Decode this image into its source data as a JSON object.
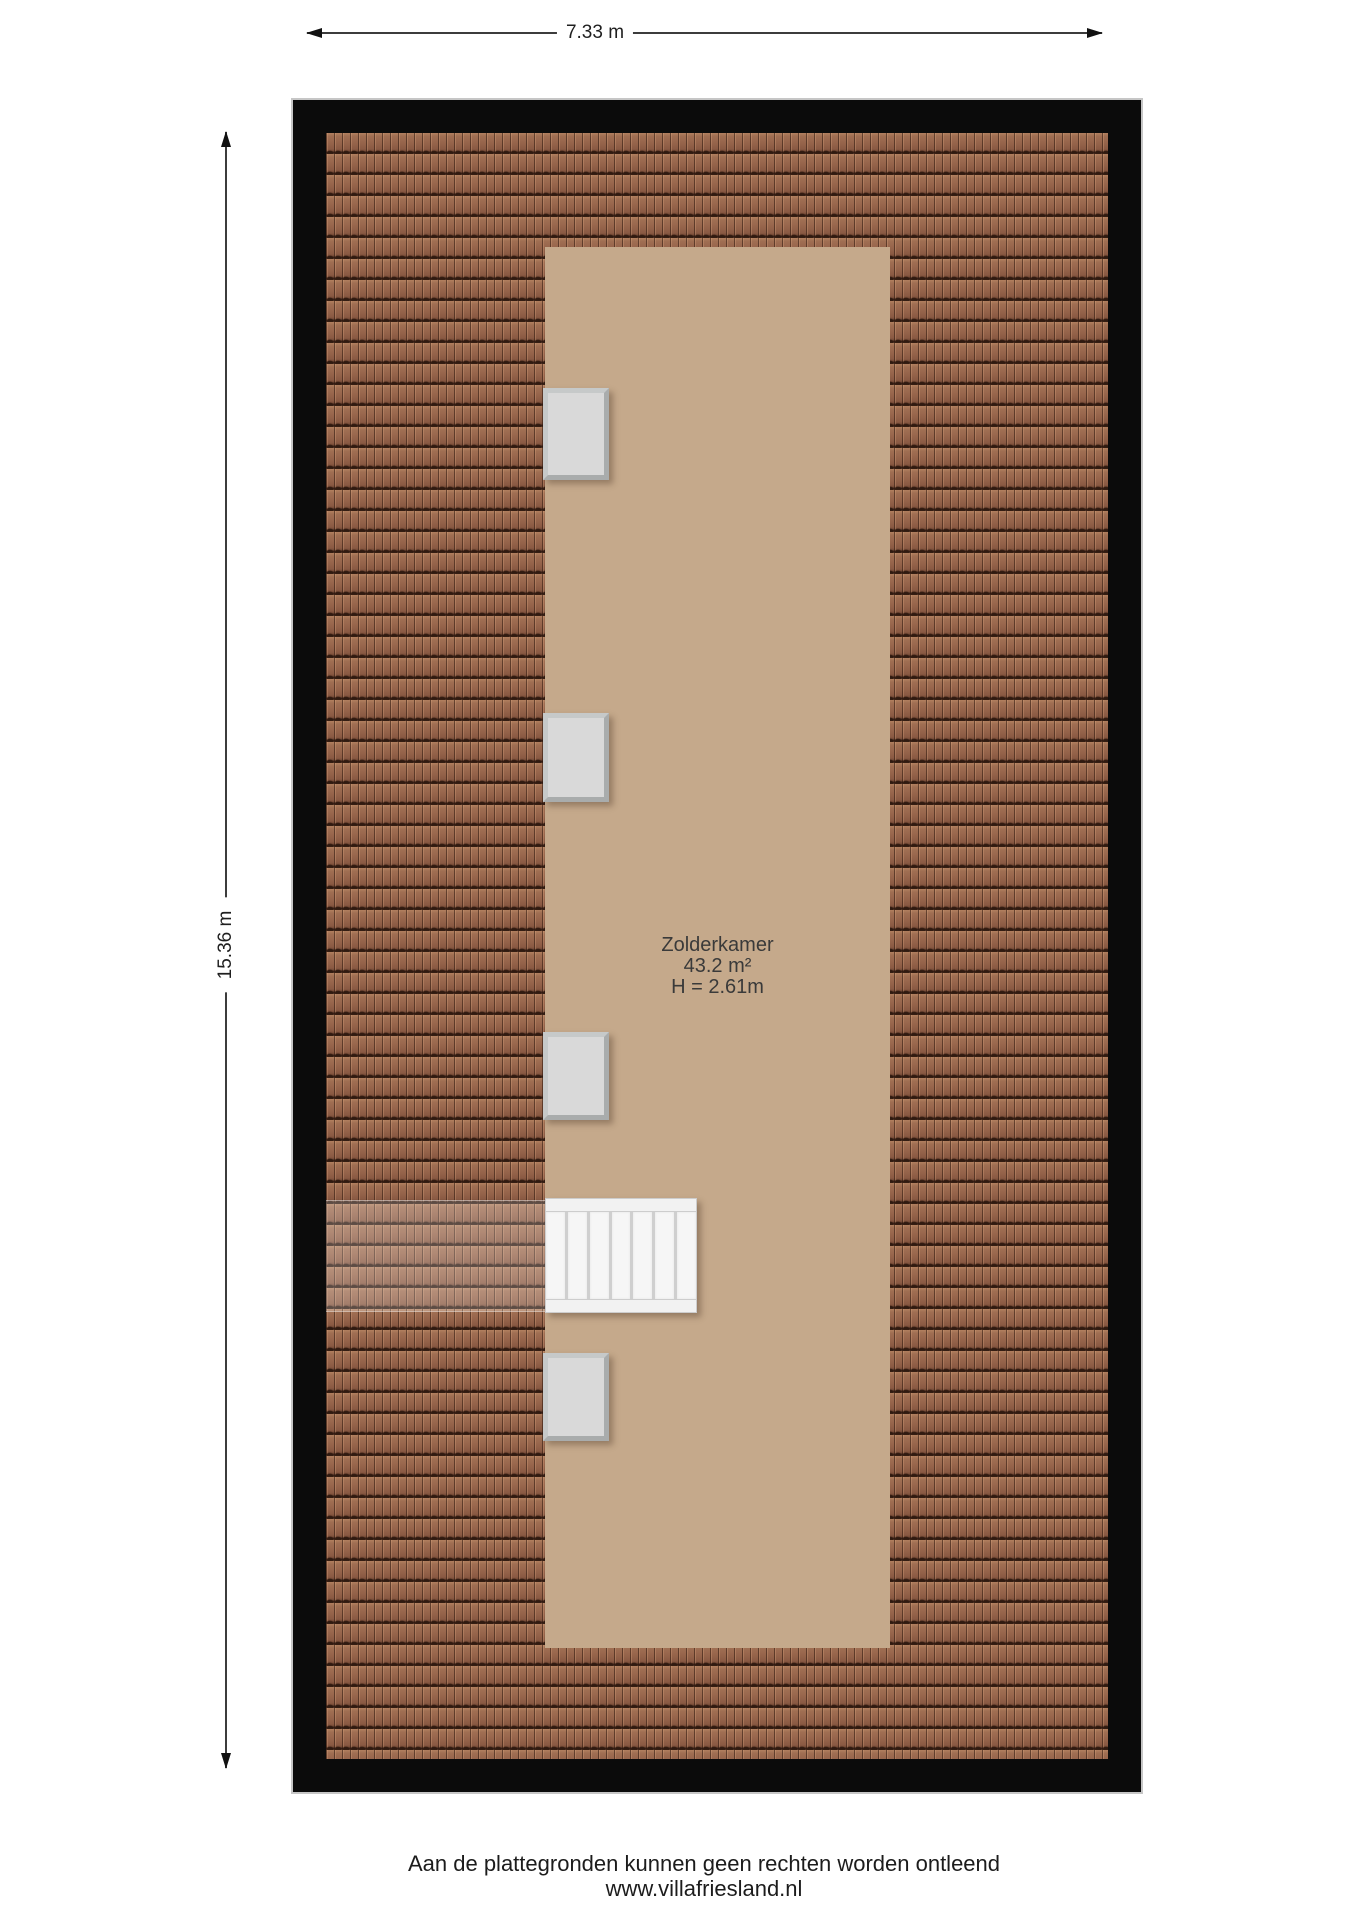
{
  "dimensions": {
    "width_label": "7.33 m",
    "height_label": "15.36 m"
  },
  "room": {
    "name": "Zolderkamer",
    "area": "43.2 m²",
    "ceiling_height": "H = 2.61m"
  },
  "features": {
    "skylight_count": 4,
    "stair_tread_count": 7
  },
  "footer": {
    "disclaimer": "Aan de plattegronden kunnen geen rechten worden ontleend",
    "website": "www.villafriesland.nl"
  },
  "colors": {
    "roof-tile": "#9a6a50",
    "roof-joint": "#3f241b",
    "room-floor": "#c5a98b",
    "plan-border": "#0b0b0b",
    "window-pane": "#d9d9d9",
    "window-frame": "#b5b8b8",
    "stair-tread": "#f6f6f6",
    "dimension-line": "#3c3c3c",
    "text": "#222222"
  }
}
